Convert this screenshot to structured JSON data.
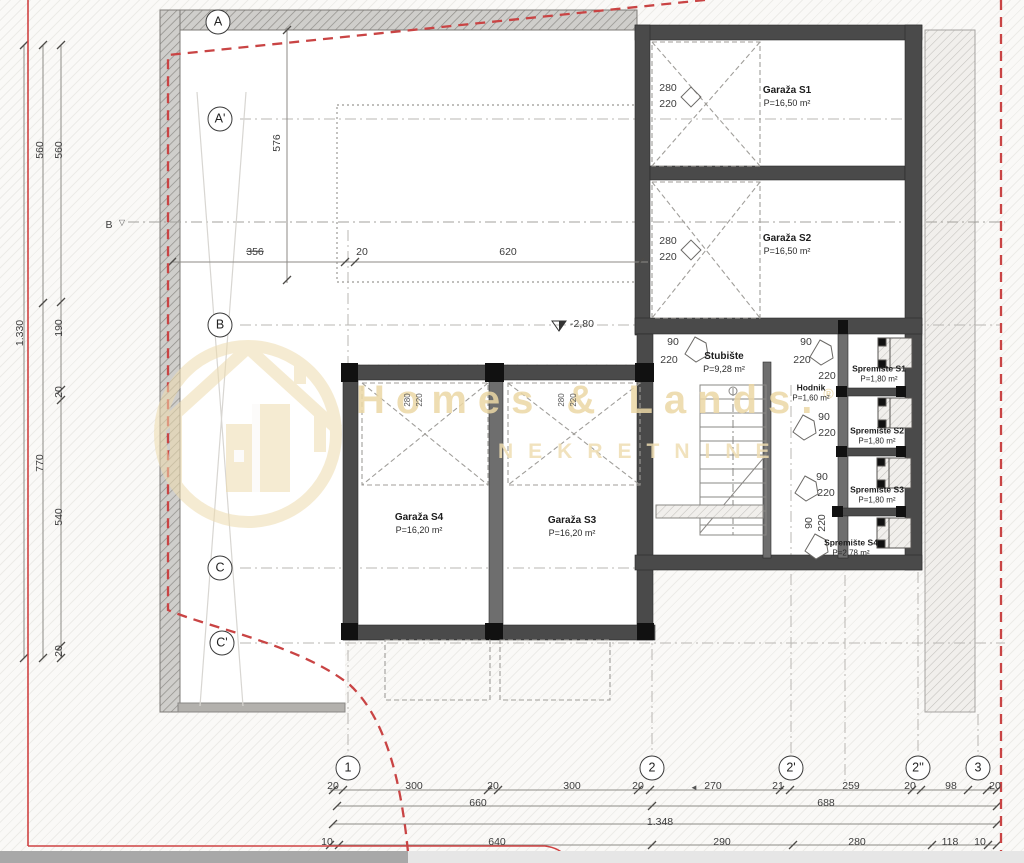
{
  "plan": {
    "watermark": {
      "line1": "Homes & Lands.",
      "reg": "®",
      "line2": "NEKRETNINE"
    },
    "colors": {
      "boundary_red": "#cc4141",
      "watermark_tan": "#ecd9a8",
      "wall_gray": "#4a4a4a"
    },
    "rooms": [
      {
        "name": "Garaža S1",
        "area": "P=16,50 m²",
        "x": 787,
        "y": 97
      },
      {
        "name": "Garaža S2",
        "area": "P=16,50 m²",
        "x": 787,
        "y": 245
      },
      {
        "name": "Garaža S4",
        "area": "P=16,20 m²",
        "x": 419,
        "y": 524
      },
      {
        "name": "Garaža S3",
        "area": "P=16,20 m²",
        "x": 572,
        "y": 527
      },
      {
        "name": "Stubište",
        "area": "P=9,28 m²",
        "x": 724,
        "y": 363
      },
      {
        "name": "Hodnik",
        "area": "P=1,60 m²",
        "x": 811,
        "y": 393,
        "sm": 1
      },
      {
        "name": "Spremište S1",
        "area": "P=1,80 m²",
        "x": 879,
        "y": 374,
        "sm": 1
      },
      {
        "name": "Spremište S2",
        "area": "P=1,80 m²",
        "x": 877,
        "y": 436,
        "sm": 1
      },
      {
        "name": "Spremište S3",
        "area": "P=1,80 m²",
        "x": 877,
        "y": 495,
        "sm": 1
      },
      {
        "name": "Spremište S4",
        "area": "P=2,78 m²",
        "x": 851,
        "y": 548,
        "sm": 1
      }
    ],
    "grid_bubbles": [
      {
        "label": "A",
        "x": 218,
        "y": 22
      },
      {
        "label": "A'",
        "x": 220,
        "y": 119
      },
      {
        "label": "B",
        "x": 220,
        "y": 325
      },
      {
        "label": "C",
        "x": 220,
        "y": 568
      },
      {
        "label": "C'",
        "x": 222,
        "y": 643
      },
      {
        "label": "1",
        "x": 348,
        "y": 768
      },
      {
        "label": "2",
        "x": 652,
        "y": 768
      },
      {
        "label": "2'",
        "x": 791,
        "y": 768
      },
      {
        "label": "2''",
        "x": 918,
        "y": 768
      },
      {
        "label": "3",
        "x": 978,
        "y": 768
      }
    ],
    "dim_labels": [
      {
        "t": "20",
        "x": 333,
        "y": 786
      },
      {
        "t": "300",
        "x": 414,
        "y": 786
      },
      {
        "t": "20",
        "x": 493,
        "y": 786
      },
      {
        "t": "300",
        "x": 572,
        "y": 786
      },
      {
        "t": "20",
        "x": 638,
        "y": 786
      },
      {
        "t": "270",
        "x": 713,
        "y": 786
      },
      {
        "t": "21",
        "x": 778,
        "y": 786
      },
      {
        "t": "259",
        "x": 851,
        "y": 786
      },
      {
        "t": "20",
        "x": 910,
        "y": 786
      },
      {
        "t": "98",
        "x": 951,
        "y": 786
      },
      {
        "t": "20",
        "x": 995,
        "y": 786
      },
      {
        "t": "660",
        "x": 478,
        "y": 803
      },
      {
        "t": "688",
        "x": 826,
        "y": 803
      },
      {
        "t": "1.348",
        "x": 660,
        "y": 822
      },
      {
        "t": "10",
        "x": 327,
        "y": 842
      },
      {
        "t": "640",
        "x": 497,
        "y": 842
      },
      {
        "t": "290",
        "x": 722,
        "y": 842
      },
      {
        "t": "280",
        "x": 857,
        "y": 842
      },
      {
        "t": "118",
        "x": 950,
        "y": 842
      },
      {
        "t": "10",
        "x": 980,
        "y": 842
      },
      {
        "t": "1.330",
        "x": 20,
        "y": 333,
        "r": 1
      },
      {
        "t": "560",
        "x": 40,
        "y": 150,
        "r": 1
      },
      {
        "t": "770",
        "x": 40,
        "y": 463,
        "r": 1
      },
      {
        "t": "560",
        "x": 59,
        "y": 150,
        "r": 1
      },
      {
        "t": "190",
        "x": 59,
        "y": 328,
        "r": 1
      },
      {
        "t": "20",
        "x": 59,
        "y": 392,
        "r": 1
      },
      {
        "t": "540",
        "x": 59,
        "y": 517,
        "r": 1
      },
      {
        "t": "20",
        "x": 59,
        "y": 651,
        "r": 1
      },
      {
        "t": "576",
        "x": 277,
        "y": 143,
        "r": 1
      },
      {
        "t": "356",
        "x": 255,
        "y": 252,
        "s": 1
      },
      {
        "t": "20",
        "x": 362,
        "y": 252
      },
      {
        "t": "620",
        "x": 508,
        "y": 252
      },
      {
        "t": "280",
        "x": 668,
        "y": 88
      },
      {
        "t": "220",
        "x": 668,
        "y": 104
      },
      {
        "t": "280",
        "x": 668,
        "y": 241
      },
      {
        "t": "220",
        "x": 668,
        "y": 257
      },
      {
        "t": "280",
        "x": 408,
        "y": 400,
        "r": 1,
        "sm": 1
      },
      {
        "t": "220",
        "x": 420,
        "y": 400,
        "r": 1,
        "sm": 1
      },
      {
        "t": "280",
        "x": 562,
        "y": 400,
        "r": 1,
        "sm": 1
      },
      {
        "t": "220",
        "x": 574,
        "y": 400,
        "r": 1,
        "sm": 1
      },
      {
        "t": "90",
        "x": 673,
        "y": 342
      },
      {
        "t": "220",
        "x": 669,
        "y": 360
      },
      {
        "t": "90",
        "x": 806,
        "y": 342
      },
      {
        "t": "220",
        "x": 802,
        "y": 360
      },
      {
        "t": "220",
        "x": 827,
        "y": 376
      },
      {
        "t": "90",
        "x": 824,
        "y": 417
      },
      {
        "t": "220",
        "x": 827,
        "y": 433
      },
      {
        "t": "90",
        "x": 822,
        "y": 477
      },
      {
        "t": "220",
        "x": 826,
        "y": 493
      },
      {
        "t": "90",
        "x": 809,
        "y": 523,
        "r": 1
      },
      {
        "t": "220",
        "x": 822,
        "y": 523,
        "r": 1
      },
      {
        "t": "-2,80",
        "x": 582,
        "y": 324
      },
      {
        "t": "B",
        "x": 109,
        "y": 225
      },
      {
        "t": "▽",
        "x": 122,
        "y": 223,
        "sm": 1
      },
      {
        "t": "◄",
        "x": 694,
        "y": 788,
        "sm": 1
      }
    ]
  }
}
